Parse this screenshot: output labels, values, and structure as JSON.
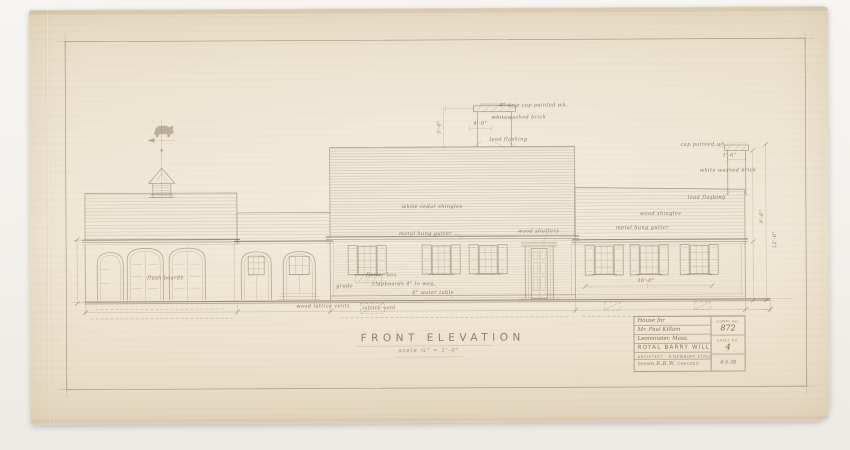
{
  "title": {
    "text": "FRONT ELEVATION",
    "scale": "scale ¼\" = 1'-0\""
  },
  "annotations": {
    "main_roof": "white cedar shingles",
    "right_roof": "wood shingles",
    "gutter_main": "metal hung gutter",
    "gutter_right": "metal hung gutter",
    "shutters": "wood shutters",
    "clapboards": "clapboards 4\" to wea.",
    "water_table": "6\" water table",
    "flower_box": "flower box",
    "grade": "grade",
    "garage_doors": "flush boards",
    "vents_left": "wood lattice vents",
    "lattice_vent": "lattice vent",
    "wing_dim": "36'-0\"",
    "dim_right_upper": "9'-6\"",
    "dim_right_lower": "12'-6\"",
    "main_chimney": {
      "cap_note": "4\" drip cap painted wh.",
      "brick_note": "whitewashed brick",
      "width_dim": "4'-0\"",
      "flashing_note": "lead flashing",
      "height_dim": "5'-6\""
    },
    "right_chimney": {
      "cap_note": "cap painted wh.",
      "brick_note": "white washed brick",
      "flashing_note": "lead flashing",
      "height_dim": "1'-6\""
    }
  },
  "title_block": {
    "house_for": "House for",
    "client": "Mr. Paul Killam",
    "location": "Leominster, Mass.",
    "firm": "ROYAL BARRY WILLS",
    "firm_address": "ARCHITECT · 8 NEWBURY STREET · BOSTON, MASS.",
    "comm_label": "COMM. NO.",
    "comm_no": "872",
    "sheet_label": "SHEET NO.",
    "sheet_no": "4",
    "date": "4-5-38",
    "drawn_label": "DRAWN",
    "drawn_value": "R.B.W.",
    "checked_label": "CHECKED"
  }
}
